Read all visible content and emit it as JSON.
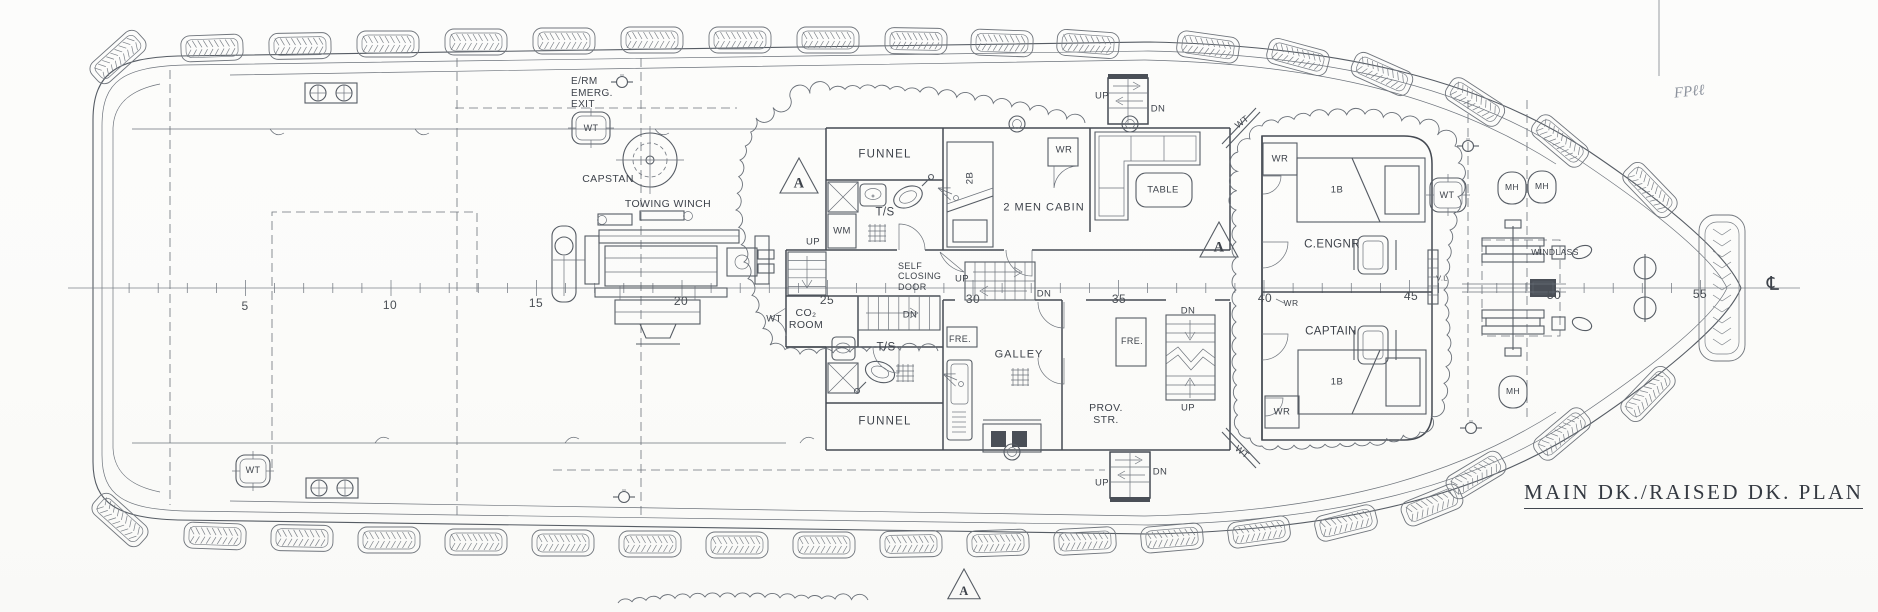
{
  "title": {
    "text": "MAIN DK./RAISED DK. PLAN"
  },
  "annotations": {
    "handwritten": "FPℓℓ",
    "centerline_symbol": "℄"
  },
  "colors": {
    "line": "#565c64",
    "wall": "#454a52",
    "label": "#3e434b",
    "handwriting": "#8d939d",
    "background": "#fcfcfb"
  },
  "stations": {
    "origin_x": 100,
    "spacing": 29.1,
    "tick_count": 55,
    "labels": [
      {
        "text": "5",
        "x": 245,
        "y": 307
      },
      {
        "text": "10",
        "x": 390,
        "y": 306
      },
      {
        "text": "15",
        "x": 536,
        "y": 304
      },
      {
        "text": "20",
        "x": 681,
        "y": 302
      },
      {
        "text": "25",
        "x": 827,
        "y": 301
      },
      {
        "text": "30",
        "x": 973,
        "y": 300
      },
      {
        "text": "35",
        "x": 1119,
        "y": 300
      },
      {
        "text": "40",
        "x": 1265,
        "y": 299
      },
      {
        "text": "45",
        "x": 1411,
        "y": 297
      },
      {
        "text": "50",
        "x": 1554,
        "y": 296
      },
      {
        "text": "55",
        "x": 1700,
        "y": 295
      }
    ]
  },
  "section_markers": [
    {
      "letter": "A",
      "x": 799,
      "y": 178,
      "s": 20
    },
    {
      "letter": "A",
      "x": 1219,
      "y": 242,
      "s": 20
    },
    {
      "letter": "A",
      "x": 964,
      "y": 586,
      "s": 17
    }
  ],
  "labels": [
    {
      "name": "erm-emerg-exit-label",
      "text": "E/RM\nEMERG.\nEXIT",
      "x": 571,
      "y": 76,
      "fs": 10,
      "anchor": "tl"
    },
    {
      "name": "wt-stern-top-hatch-label",
      "text": "WT",
      "x": 591,
      "y": 128,
      "fs": 9
    },
    {
      "name": "capstan-label",
      "text": "CAPSTAN",
      "x": 608,
      "y": 179,
      "fs": 10.5
    },
    {
      "name": "towing-winch-label",
      "text": "TOWING  WINCH",
      "x": 668,
      "y": 204,
      "fs": 10.5
    },
    {
      "name": "funnel-top-label",
      "text": "FUNNEL",
      "x": 885,
      "y": 155,
      "fs": 11.5,
      "ls": 1.2
    },
    {
      "name": "ts-top-label",
      "text": "T/S",
      "x": 885,
      "y": 213,
      "fs": 11.5
    },
    {
      "name": "wm-label",
      "text": "WM",
      "x": 842,
      "y": 231,
      "fs": 9.5
    },
    {
      "name": "up-boatdeck-stair-label",
      "text": "UP",
      "x": 813,
      "y": 242,
      "fs": 9.5
    },
    {
      "name": "self-closing-door-label",
      "text": "SELF\nCLOSING\nDOOR",
      "x": 898,
      "y": 261,
      "fs": 9,
      "anchor": "tl"
    },
    {
      "name": "dn-central-stair-label",
      "text": "DN",
      "x": 910,
      "y": 315,
      "fs": 9.5
    },
    {
      "name": "co2-room-label",
      "text": "CO₂\nROOM",
      "x": 806,
      "y": 319,
      "fs": 10.5
    },
    {
      "name": "wt-co2-door-label",
      "text": "WT",
      "x": 774,
      "y": 319,
      "fs": 9.5
    },
    {
      "name": "bunk-2b-label",
      "text": "2B",
      "x": 970,
      "y": 178,
      "fs": 9.5,
      "rot": -90
    },
    {
      "name": "two-men-cabin-label",
      "text": "2 MEN  CABIN",
      "x": 1044,
      "y": 208,
      "fs": 11,
      "ls": 1
    },
    {
      "name": "wr-2men-label",
      "text": "WR",
      "x": 1064,
      "y": 150,
      "fs": 9.5
    },
    {
      "name": "up-ext-top-label",
      "text": "UP",
      "x": 1102,
      "y": 96,
      "fs": 9.5
    },
    {
      "name": "dn-ext-top-label",
      "text": "DN",
      "x": 1158,
      "y": 109,
      "fs": 9.5
    },
    {
      "name": "table-label",
      "text": "TABLE",
      "x": 1163,
      "y": 190,
      "fs": 9.5
    },
    {
      "name": "wt-lobby-top-label",
      "text": "WT",
      "x": 1242,
      "y": 122,
      "fs": 9,
      "rot": -38
    },
    {
      "name": "up-galley-stair-label",
      "text": "UP",
      "x": 962,
      "y": 279,
      "fs": 9.5
    },
    {
      "name": "dn-galley-stair-label",
      "text": "DN",
      "x": 1044,
      "y": 294,
      "fs": 9.5
    },
    {
      "name": "fre-galley-label",
      "text": "FRE.",
      "x": 960,
      "y": 339,
      "fs": 9
    },
    {
      "name": "galley-label",
      "text": "GALLEY",
      "x": 1019,
      "y": 355,
      "fs": 11,
      "ls": 1
    },
    {
      "name": "fre-prov-label",
      "text": "FRE.",
      "x": 1132,
      "y": 341,
      "fs": 9
    },
    {
      "name": "dn-prov-stair-label",
      "text": "DN",
      "x": 1188,
      "y": 311,
      "fs": 9.5
    },
    {
      "name": "up-prov-stair-label",
      "text": "UP",
      "x": 1188,
      "y": 408,
      "fs": 9.5
    },
    {
      "name": "prov-str-label",
      "text": "PROV.\nSTR.",
      "x": 1106,
      "y": 414,
      "fs": 10.5
    },
    {
      "name": "ts-bottom-label",
      "text": "T/S",
      "x": 886,
      "y": 348,
      "fs": 11.5
    },
    {
      "name": "funnel-bottom-label",
      "text": "FUNNEL",
      "x": 885,
      "y": 422,
      "fs": 11.5,
      "ls": 1.2
    },
    {
      "name": "up-ext-bottom-label",
      "text": "UP",
      "x": 1102,
      "y": 483,
      "fs": 9.5
    },
    {
      "name": "dn-ext-bottom-label",
      "text": "DN",
      "x": 1160,
      "y": 472,
      "fs": 9.5
    },
    {
      "name": "wt-lobby-bottom-label",
      "text": "WT",
      "x": 1242,
      "y": 452,
      "fs": 9,
      "rot": 38
    },
    {
      "name": "wr-fore-top-label",
      "text": "WR",
      "x": 1280,
      "y": 159,
      "fs": 9.5
    },
    {
      "name": "chief-engineer-cabin-label",
      "text": "C.ENGNR",
      "x": 1332,
      "y": 245,
      "fs": 11.5
    },
    {
      "name": "bed-1b-top-label",
      "text": "1B",
      "x": 1337,
      "y": 190,
      "fs": 9.5
    },
    {
      "name": "wt-fore-hatch-label",
      "text": "WT",
      "x": 1447,
      "y": 195,
      "fs": 9
    },
    {
      "name": "wr-mid-label",
      "text": "WR",
      "x": 1291,
      "y": 304,
      "fs": 8.5
    },
    {
      "name": "captain-cabin-label",
      "text": "CAPTAIN",
      "x": 1331,
      "y": 332,
      "fs": 11.5
    },
    {
      "name": "bed-1b-bottom-label",
      "text": "1B",
      "x": 1337,
      "y": 382,
      "fs": 9.5
    },
    {
      "name": "wr-fore-bottom-label",
      "text": "WR",
      "x": 1282,
      "y": 412,
      "fs": 9.5
    },
    {
      "name": "vertical-ladder-label",
      "text": "V.L",
      "x": 1442,
      "y": 279,
      "fs": 7.5
    },
    {
      "name": "windlass-label",
      "text": "WINDLASS",
      "x": 1555,
      "y": 253,
      "fs": 8.5
    },
    {
      "name": "manhole-1-label",
      "text": "MH",
      "x": 1512,
      "y": 188,
      "fs": 8.5
    },
    {
      "name": "manhole-2-label",
      "text": "MH",
      "x": 1542,
      "y": 187,
      "fs": 8.5
    },
    {
      "name": "manhole-3-label",
      "text": "MH",
      "x": 1513,
      "y": 392,
      "fs": 8.5
    },
    {
      "name": "wt-stern-bottom-hatch-label",
      "text": "WT",
      "x": 253,
      "y": 470,
      "fs": 9
    }
  ],
  "fenders": {
    "top": [
      [
        118,
        57,
        -42
      ],
      [
        212,
        48,
        -2
      ],
      [
        300,
        46,
        -1
      ],
      [
        388,
        44,
        0
      ],
      [
        476,
        42,
        0
      ],
      [
        564,
        41,
        0
      ],
      [
        652,
        40,
        0
      ],
      [
        740,
        40,
        0
      ],
      [
        828,
        40,
        0
      ],
      [
        916,
        41,
        1
      ],
      [
        1002,
        43,
        2
      ],
      [
        1088,
        44,
        4
      ],
      [
        1208,
        47,
        8
      ],
      [
        1298,
        57,
        15
      ],
      [
        1382,
        74,
        24
      ],
      [
        1475,
        102,
        33
      ],
      [
        1560,
        141,
        40
      ],
      [
        1650,
        190,
        46
      ]
    ],
    "bottom": [
      [
        120,
        520,
        42
      ],
      [
        215,
        536,
        2
      ],
      [
        302,
        538,
        1
      ],
      [
        389,
        540,
        0
      ],
      [
        476,
        542,
        0
      ],
      [
        563,
        543,
        0
      ],
      [
        650,
        544,
        0
      ],
      [
        737,
        545,
        0
      ],
      [
        824,
        545,
        0
      ],
      [
        911,
        544,
        -1
      ],
      [
        998,
        543,
        -2
      ],
      [
        1085,
        541,
        -3
      ],
      [
        1172,
        538,
        -5
      ],
      [
        1259,
        532,
        -8
      ],
      [
        1346,
        523,
        -14
      ],
      [
        1432,
        505,
        -22
      ],
      [
        1476,
        475,
        -31
      ],
      [
        1562,
        434,
        -40
      ],
      [
        1648,
        394,
        -46
      ]
    ],
    "bow_pad": {
      "x": 1722,
      "y": 288,
      "w": 46,
      "h": 146
    }
  }
}
